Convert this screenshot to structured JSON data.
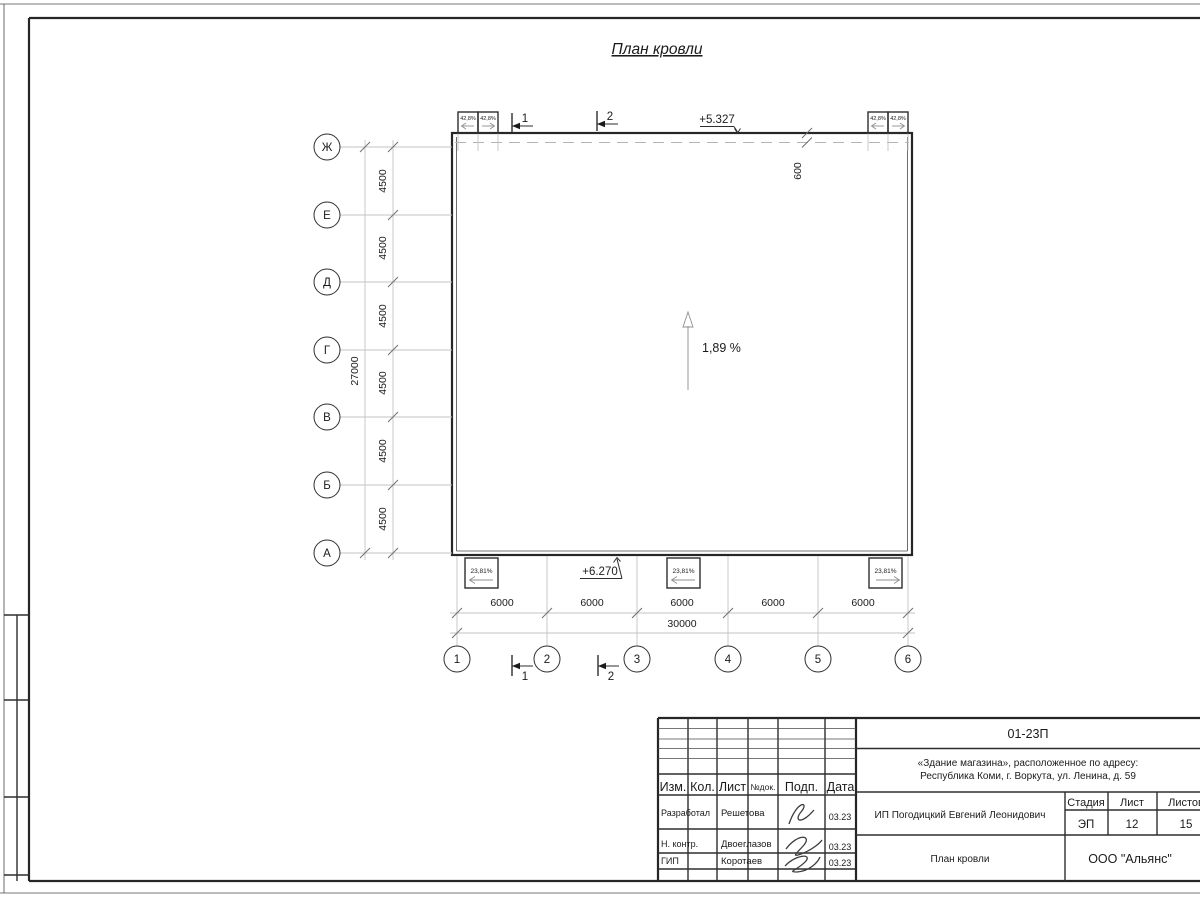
{
  "title": "План кровли",
  "grid": {
    "row_axes": [
      "Ж",
      "Е",
      "Д",
      "Г",
      "В",
      "Б",
      "А"
    ],
    "col_axes": [
      "1",
      "2",
      "3",
      "4",
      "5",
      "6"
    ],
    "row_spacing_label": "4500",
    "row_total_label": "27000",
    "col_spacing_label": "6000",
    "col_total_label": "30000",
    "overhang_label": "600"
  },
  "marks": {
    "elevation_top": "+5.327",
    "elevation_bottom": "+6.270",
    "main_slope": "1,89 %",
    "funnel_slope": "42,8%",
    "canopy_slope": "23,81%",
    "section_1": "1",
    "section_2": "2"
  },
  "titleblock": {
    "doc_number": "01-23П",
    "object_line1": "«Здание магазина», расположенное по адресу:",
    "object_line2": "Республика Коми, г. Воркута, ул. Ленина, д. 59",
    "client": "ИП Погодицкий Евгений Леонидович",
    "sheet_title": "План кровли",
    "company": "ООО \"Альянс\"",
    "stage_label": "Стадия",
    "sheet_label": "Лист",
    "sheets_label": "Листов",
    "stage": "ЭП",
    "sheet": "12",
    "sheets": "15",
    "col_izm": "Изм.",
    "col_kol": "Кол.",
    "col_list": "Лист",
    "col_doc": "№док.",
    "col_podp": "Подп.",
    "col_data": "Дата",
    "row1_role": "Разработал",
    "row1_name": "Решетова",
    "row1_date": "03.23",
    "row2_role": "Н. контр.",
    "row2_name": "Двоеглазов",
    "row2_date": "03.23",
    "row3_role": "ГИП",
    "row3_name": "Коротаев",
    "row3_date": "03.23"
  }
}
